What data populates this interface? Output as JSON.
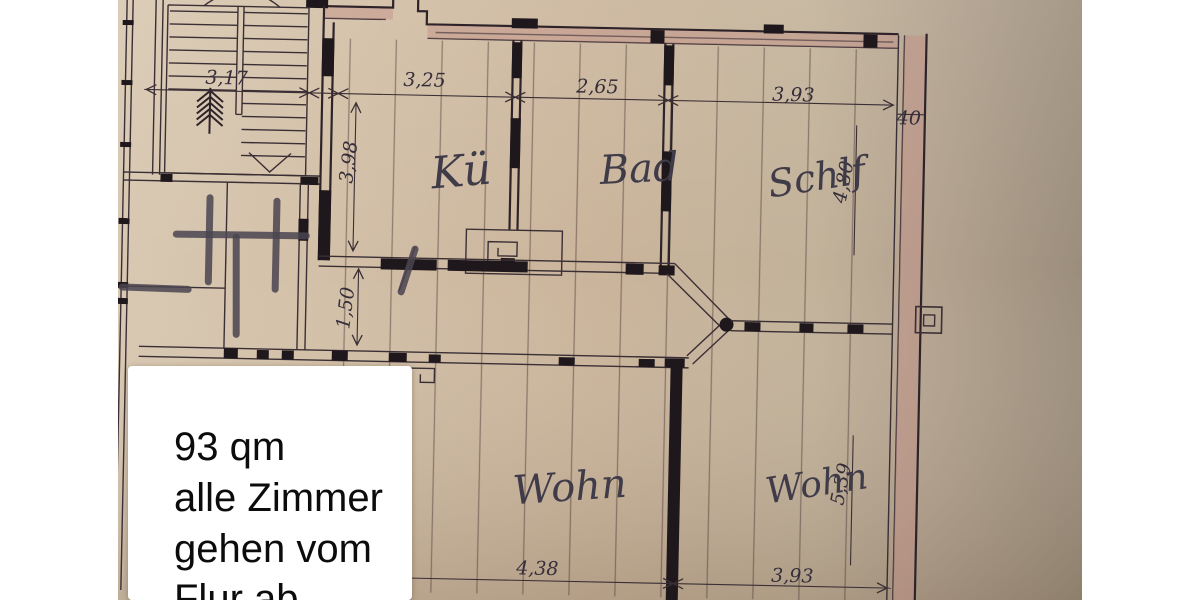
{
  "note_box": {
    "lines": [
      "93 qm",
      "alle Zimmer",
      "gehen vom",
      "Flur ab"
    ]
  },
  "plan": {
    "room_labels": [
      {
        "id": "kitchen",
        "label": "Kü"
      },
      {
        "id": "bath",
        "label": "Bad"
      },
      {
        "id": "bedroom",
        "label": "Schlf"
      },
      {
        "id": "living-left",
        "label": "Wohn"
      },
      {
        "id": "living-right",
        "label": "Wohn"
      }
    ],
    "dims": {
      "stairs_width": "3,17",
      "kitchen_width": "3,25",
      "bath_width": "2,65",
      "bedroom_width": "3,93",
      "wall_thickness": "40",
      "kitchen_depth": "3,98",
      "corridor_width": "1,50",
      "bedroom_depth": "4,80",
      "living_right_depth": "5,39",
      "living_left_width": "4,38",
      "living_right_width": "3,93"
    },
    "colors": {
      "paper": "#cdb79f",
      "ink": "#3a2f35",
      "wall_fill": "#c08f85",
      "pencil": "#4a4450",
      "page": "#ffffff"
    }
  }
}
